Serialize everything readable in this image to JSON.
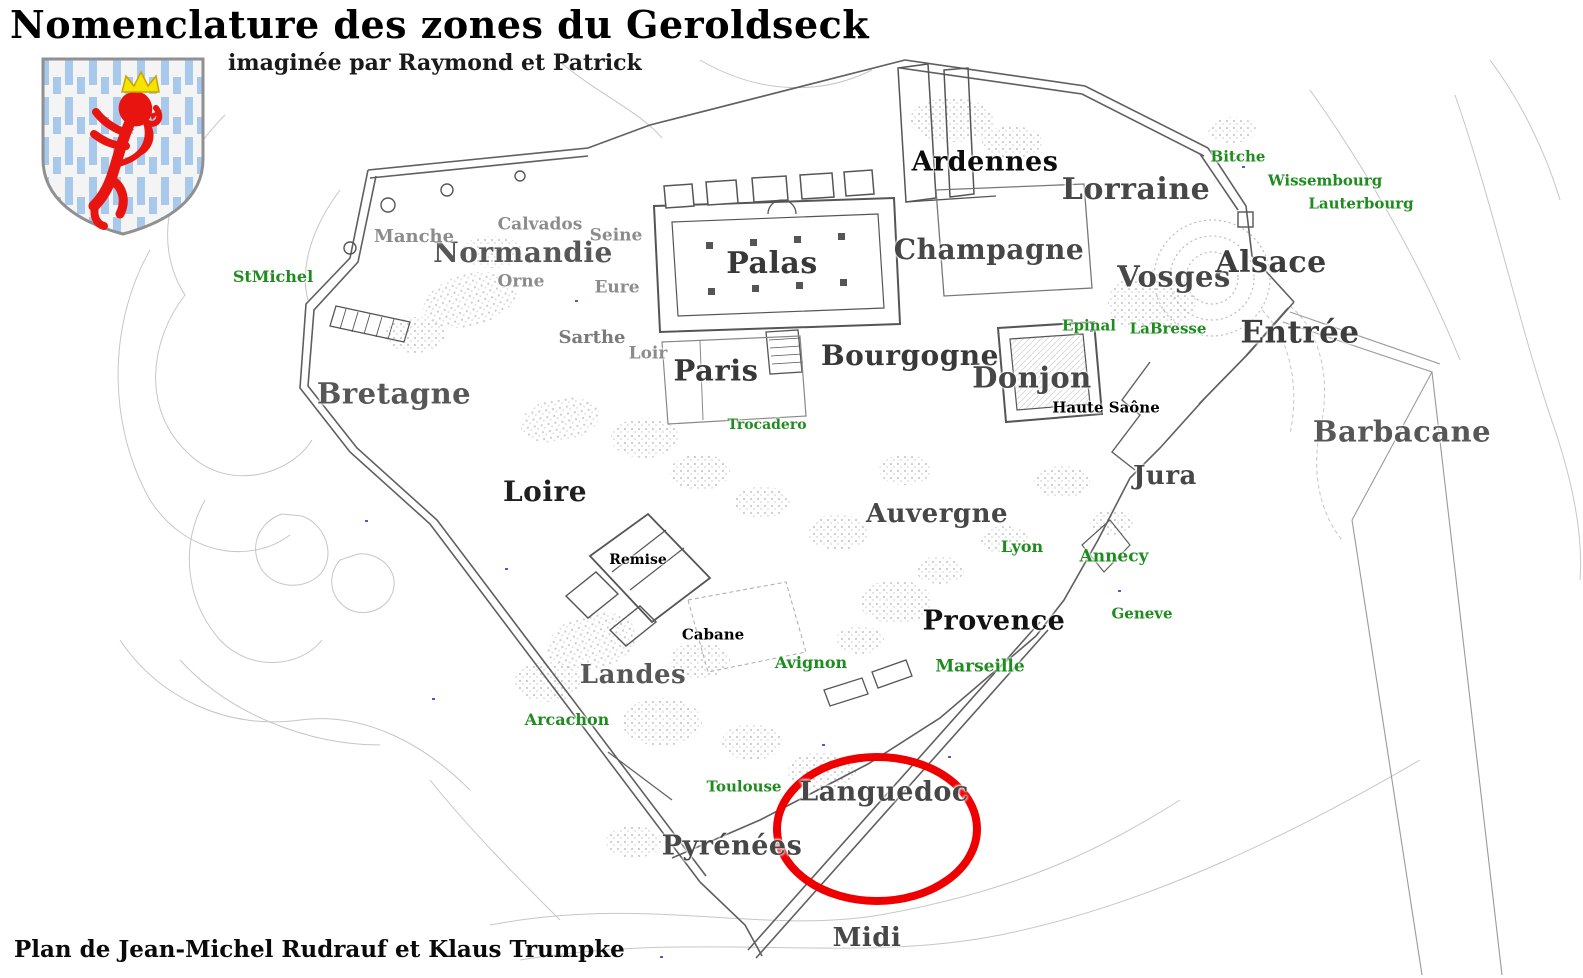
{
  "header": {
    "title": "Nomenclature des zones du Geroldseck",
    "subtitle": "imaginée par Raymond et Patrick",
    "credit": "Plan de Jean-Michel Rudrauf et Klaus Trumpke"
  },
  "colors": {
    "zone_label": "#474747",
    "minor_label": "#8c8c8c",
    "black_label": "#000000",
    "locality_label": "#1e8c1e",
    "highlight_ellipse": "#ee0000",
    "wall": "#5f5f5f",
    "contour": "#c6c6c6",
    "shield_blue": "#a9c9ec",
    "lion_red": "#e8140f",
    "crown_yellow": "#f5e400"
  },
  "highlight": {
    "shape": "ellipse",
    "cx": 877,
    "cy": 829,
    "rx": 100,
    "ry": 72,
    "stroke_width": 8,
    "encircled_zone": "Languedoc"
  },
  "labels": [
    {
      "text": "Ardennes",
      "x": 985,
      "y": 162,
      "size": 27,
      "type": "zone",
      "color": "#0c0c0c"
    },
    {
      "text": "Lorraine",
      "x": 1136,
      "y": 190,
      "size": 30,
      "type": "zone"
    },
    {
      "text": "Normandie",
      "x": 523,
      "y": 253,
      "size": 28,
      "type": "zone",
      "color": "#575757"
    },
    {
      "text": "Palas",
      "x": 772,
      "y": 264,
      "size": 30,
      "type": "zone",
      "color": "#383838"
    },
    {
      "text": "Champagne",
      "x": 989,
      "y": 250,
      "size": 28,
      "type": "zone"
    },
    {
      "text": "Vosges",
      "x": 1174,
      "y": 277,
      "size": 29,
      "type": "zone"
    },
    {
      "text": "Alsace",
      "x": 1271,
      "y": 263,
      "size": 30,
      "type": "zone",
      "color": "#3d3d3d"
    },
    {
      "text": "Entrée",
      "x": 1300,
      "y": 333,
      "size": 31,
      "type": "zone",
      "color": "#3d3d3d"
    },
    {
      "text": "Paris",
      "x": 716,
      "y": 371,
      "size": 29,
      "type": "zone",
      "color": "#383838"
    },
    {
      "text": "Bourgogne",
      "x": 910,
      "y": 356,
      "size": 28,
      "type": "zone",
      "color": "#383838"
    },
    {
      "text": "Donjon",
      "x": 1032,
      "y": 378,
      "size": 29,
      "type": "zone"
    },
    {
      "text": "Barbacane",
      "x": 1402,
      "y": 432,
      "size": 29,
      "type": "zone",
      "color": "#575757"
    },
    {
      "text": "Bretagne",
      "x": 394,
      "y": 394,
      "size": 29,
      "type": "zone",
      "color": "#575757"
    },
    {
      "text": "Loire",
      "x": 545,
      "y": 492,
      "size": 28,
      "type": "zone",
      "color": "#1f1f1f"
    },
    {
      "text": "Jura",
      "x": 1165,
      "y": 476,
      "size": 26,
      "type": "zone"
    },
    {
      "text": "Auvergne",
      "x": 937,
      "y": 514,
      "size": 26,
      "type": "zone"
    },
    {
      "text": "Provence",
      "x": 994,
      "y": 621,
      "size": 27,
      "type": "zone",
      "color": "#121212"
    },
    {
      "text": "Landes",
      "x": 633,
      "y": 675,
      "size": 26,
      "type": "zone",
      "color": "#575757"
    },
    {
      "text": "Languedoc",
      "x": 884,
      "y": 792,
      "size": 27,
      "type": "zone"
    },
    {
      "text": "Pyrénées",
      "x": 732,
      "y": 846,
      "size": 27,
      "type": "zone"
    },
    {
      "text": "Midi",
      "x": 867,
      "y": 938,
      "size": 26,
      "type": "zone"
    },
    {
      "text": "Manche",
      "x": 414,
      "y": 237,
      "size": 18,
      "type": "minor"
    },
    {
      "text": "Calvados",
      "x": 540,
      "y": 225,
      "size": 17,
      "type": "minor"
    },
    {
      "text": "Seine",
      "x": 616,
      "y": 236,
      "size": 17,
      "type": "minor"
    },
    {
      "text": "Orne",
      "x": 521,
      "y": 282,
      "size": 17,
      "type": "minor"
    },
    {
      "text": "Eure",
      "x": 617,
      "y": 288,
      "size": 17,
      "type": "minor"
    },
    {
      "text": "Sarthe",
      "x": 592,
      "y": 338,
      "size": 18,
      "type": "minor",
      "color": "#7a7a7a"
    },
    {
      "text": "Loir",
      "x": 648,
      "y": 354,
      "size": 17,
      "type": "minor"
    },
    {
      "text": "Haute Saône",
      "x": 1106,
      "y": 408,
      "size": 15,
      "type": "black"
    },
    {
      "text": "Remise",
      "x": 638,
      "y": 560,
      "size": 14,
      "type": "black"
    },
    {
      "text": "Cabane",
      "x": 713,
      "y": 635,
      "size": 15,
      "type": "black"
    },
    {
      "text": "StMichel",
      "x": 273,
      "y": 277,
      "size": 16,
      "type": "locality"
    },
    {
      "text": "Bitche",
      "x": 1238,
      "y": 157,
      "size": 15,
      "type": "locality"
    },
    {
      "text": "Wissembourg",
      "x": 1325,
      "y": 181,
      "size": 15,
      "type": "locality"
    },
    {
      "text": "Lauterbourg",
      "x": 1361,
      "y": 204,
      "size": 15,
      "type": "locality"
    },
    {
      "text": "Epinal",
      "x": 1089,
      "y": 326,
      "size": 15,
      "type": "locality"
    },
    {
      "text": "LaBresse",
      "x": 1168,
      "y": 329,
      "size": 15,
      "type": "locality"
    },
    {
      "text": "Trocadero",
      "x": 767,
      "y": 425,
      "size": 14,
      "type": "locality"
    },
    {
      "text": "Lyon",
      "x": 1022,
      "y": 547,
      "size": 16,
      "type": "locality"
    },
    {
      "text": "Annecy",
      "x": 1114,
      "y": 557,
      "size": 17,
      "type": "locality"
    },
    {
      "text": "Geneve",
      "x": 1142,
      "y": 614,
      "size": 15,
      "type": "locality"
    },
    {
      "text": "Avignon",
      "x": 811,
      "y": 663,
      "size": 16,
      "type": "locality"
    },
    {
      "text": "Marseille",
      "x": 980,
      "y": 667,
      "size": 17,
      "type": "locality"
    },
    {
      "text": "Arcachon",
      "x": 567,
      "y": 720,
      "size": 16,
      "type": "locality"
    },
    {
      "text": "Toulouse",
      "x": 744,
      "y": 787,
      "size": 15,
      "type": "locality"
    }
  ]
}
